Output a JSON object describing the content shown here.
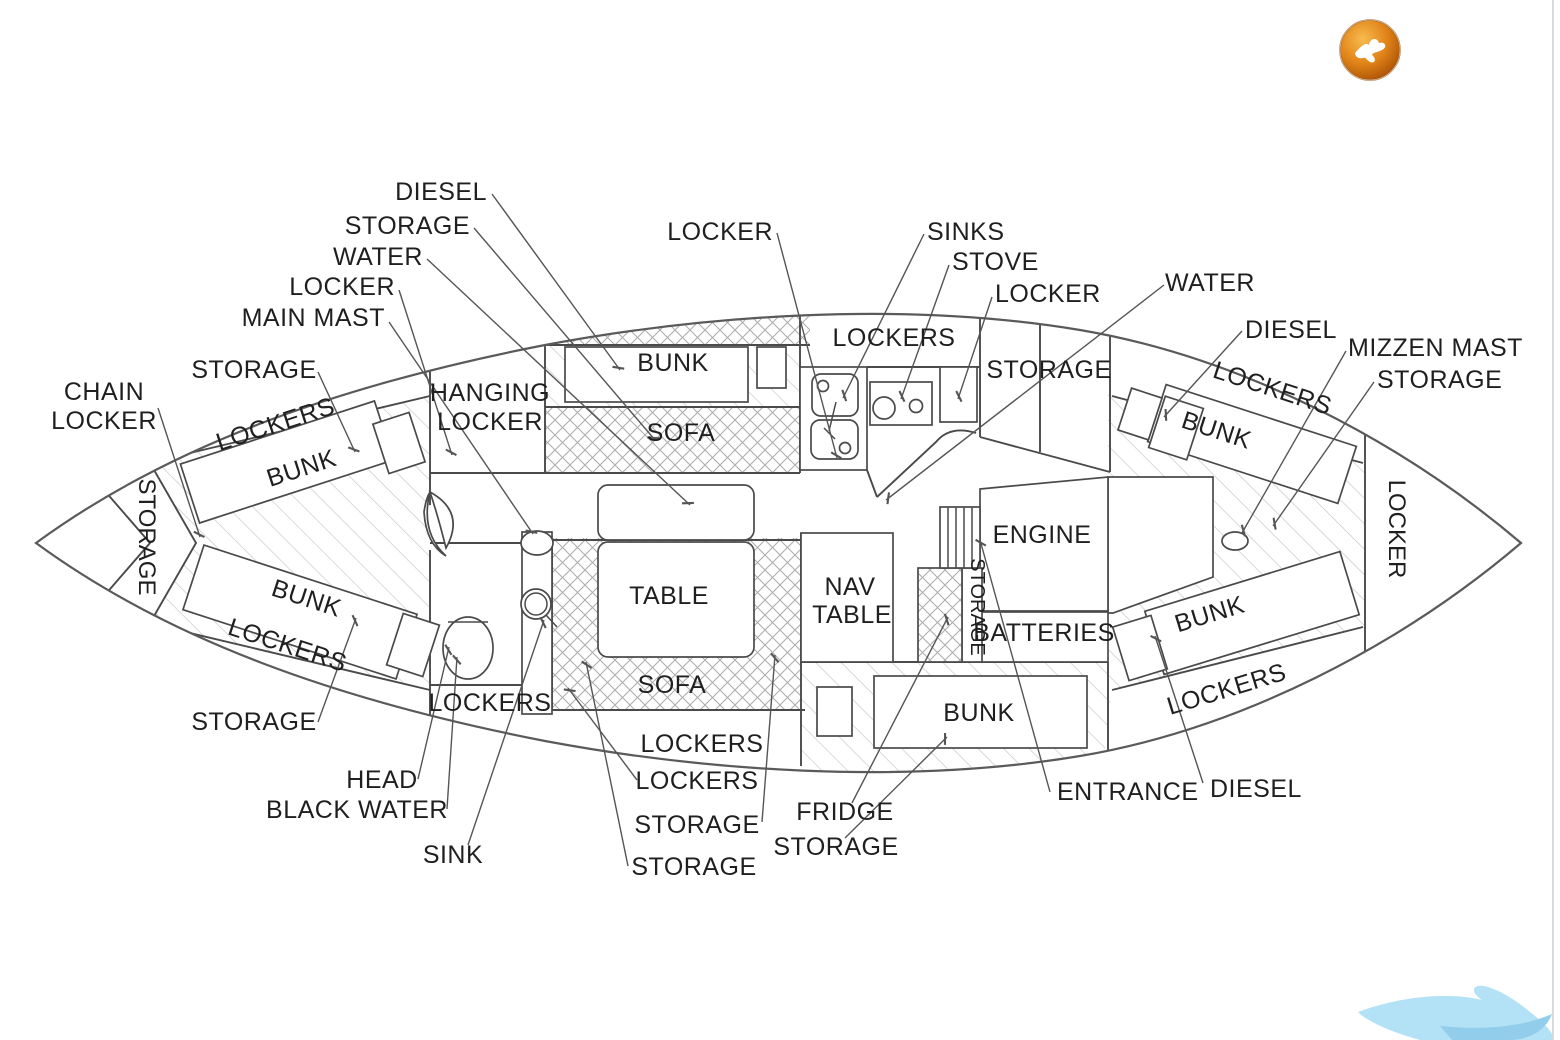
{
  "diagram": {
    "labels": {
      "fwd_diesel": "DIESEL",
      "fwd_storage": "STORAGE",
      "fwd_water": "WATER",
      "fwd_locker": "LOCKER",
      "main_mast": "MAIN MAST",
      "vberth_storage_top": "STORAGE",
      "chain_locker_line1": "CHAIN",
      "chain_locker_line2": "LOCKER",
      "bow_storage_vertical": "STORAGE",
      "vberth_lockers_top": "LOCKERS",
      "vberth_bunk_top": "BUNK",
      "vberth_bunk_bottom": "BUNK",
      "vberth_lockers_bottom": "LOCKERS",
      "vberth_storage_bottom": "STORAGE",
      "hanging_locker_line1": "HANGING",
      "hanging_locker_line2": "LOCKER",
      "fwd_cabin_bunk": "BUNK",
      "fwd_cabin_sofa": "SOFA",
      "galley_locker_callout": "LOCKER",
      "galley_sinks": "SINKS",
      "galley_stove": "STOVE",
      "galley_locker2": "LOCKER",
      "galley_lockers_band": "LOCKERS",
      "galley_storage": "STORAGE",
      "aft_water": "WATER",
      "aft_diesel_top": "DIESEL",
      "mizzen_mast": "MIZZEN MAST",
      "aft_storage_top": "STORAGE",
      "aft_lockers_top": "LOCKERS",
      "aft_bunk_top": "BUNK",
      "stern_locker": "LOCKER",
      "salon_table": "TABLE",
      "nav_table_line1": "NAV",
      "nav_table_line2": "TABLE",
      "engine": "ENGINE",
      "engine_storage_vertical": "STORAGE",
      "batteries": "BATTERIES",
      "salon_sofa": "SOFA",
      "head_lockers": "LOCKERS",
      "salon_lockers_band": "LOCKERS",
      "salon_lockers_callout": "LOCKERS",
      "quarter_bunk": "BUNK",
      "aft_bunk_bottom": "BUNK",
      "aft_lockers_bottom": "LOCKERS",
      "head": "HEAD",
      "black_water": "BLACK WATER",
      "sink": "SINK",
      "salon_storage_1": "STORAGE",
      "salon_storage_2": "STORAGE",
      "fridge": "FRIDGE",
      "quarter_storage": "STORAGE",
      "entrance": "ENTRANCE",
      "aft_diesel_bottom": "DIESEL"
    },
    "colors": {
      "line": "#4a4a4a",
      "hatch_light": "#c6c6c6",
      "hatch_cross": "#ababab",
      "logo_orange_light": "#f8bb4e",
      "logo_orange_dark": "#a84f04",
      "watermark_blue": "#a6dcf4",
      "watermark_blue_dark": "#7fc6e8",
      "edge_line": "#d9d9d9"
    }
  }
}
